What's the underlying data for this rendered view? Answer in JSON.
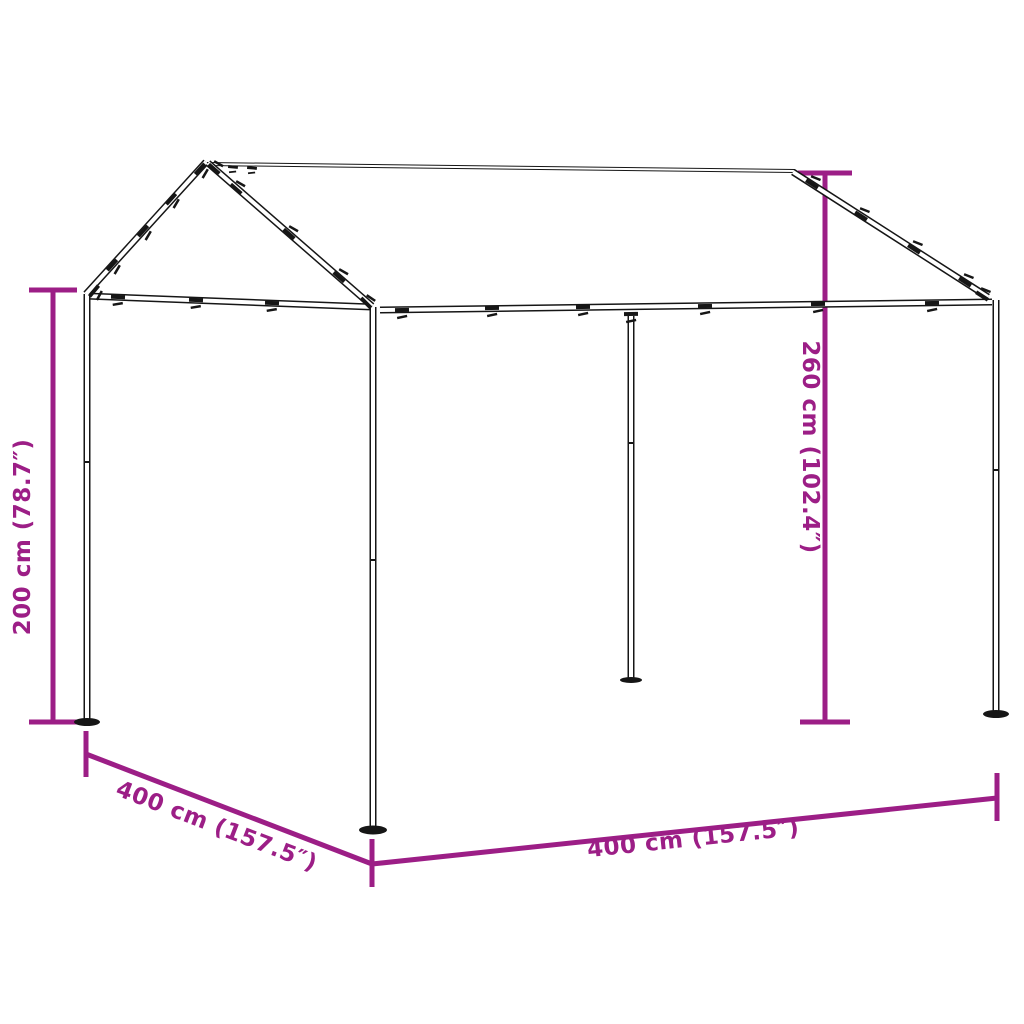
{
  "diagram": {
    "accent_color": "#9C1E86",
    "frame_color": "#161616",
    "dimensions": {
      "height_left": "200 cm (78.7″)",
      "height_right": "260 cm (102.4″)",
      "depth_left": "400 cm (157.5″)",
      "width_front": "400 cm (157.5″)"
    }
  }
}
